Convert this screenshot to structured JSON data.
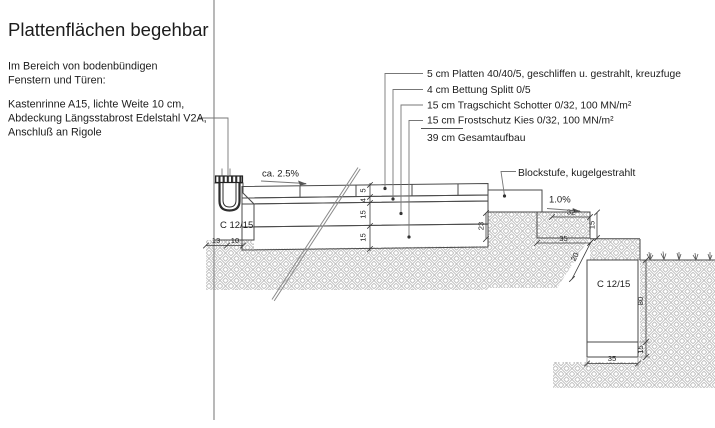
{
  "title": "Plattenflächen begehbar",
  "context_note": {
    "line1": "Im Bereich von bodenbündigen",
    "line2": "Fenstern und Türen:"
  },
  "drain_note": {
    "line1": "Kastenrinne A15, lichte Weite 10 cm,",
    "line2": "Abdeckung Längsstabrost Edelstahl V2A,",
    "line3": "Anschluß an Rigole"
  },
  "layers": {
    "platten": "5 cm Platten 40/40/5, geschliffen u. gestrahlt, kreuzfuge",
    "bettung": "4 cm Bettung Splitt 0/5",
    "tragschicht": "15 cm Tragschicht Schotter 0/32, 100 MN/m²",
    "frostschutz": "15 cm Frostschutz Kies 0/32, 100 MN/m²",
    "total": "39 cm Gesamtaufbau"
  },
  "labels": {
    "blockstufe": "Blockstufe, kugelgestrahlt",
    "slope_main": "ca. 2.5%",
    "slope_step": "1.0%",
    "concrete_drain": "C 12/15",
    "concrete_foundation": "C 12/15"
  },
  "dims": {
    "drain_a": "13",
    "drain_b": "10",
    "chain_platten": "5",
    "chain_bettung": "4",
    "chain_tragschicht": "15",
    "chain_frostschutz": "15",
    "step_top_width": "32",
    "step_left_height": "23",
    "step_bottom_width": "35",
    "step_right_height": "15",
    "foundation_cover": "20",
    "foundation_height": "80",
    "footing_height": "15",
    "foundation_width": "35"
  },
  "colors": {
    "line": "#4a4a4a",
    "text": "#1c1c1c",
    "hatch": "#bdbdbd"
  }
}
